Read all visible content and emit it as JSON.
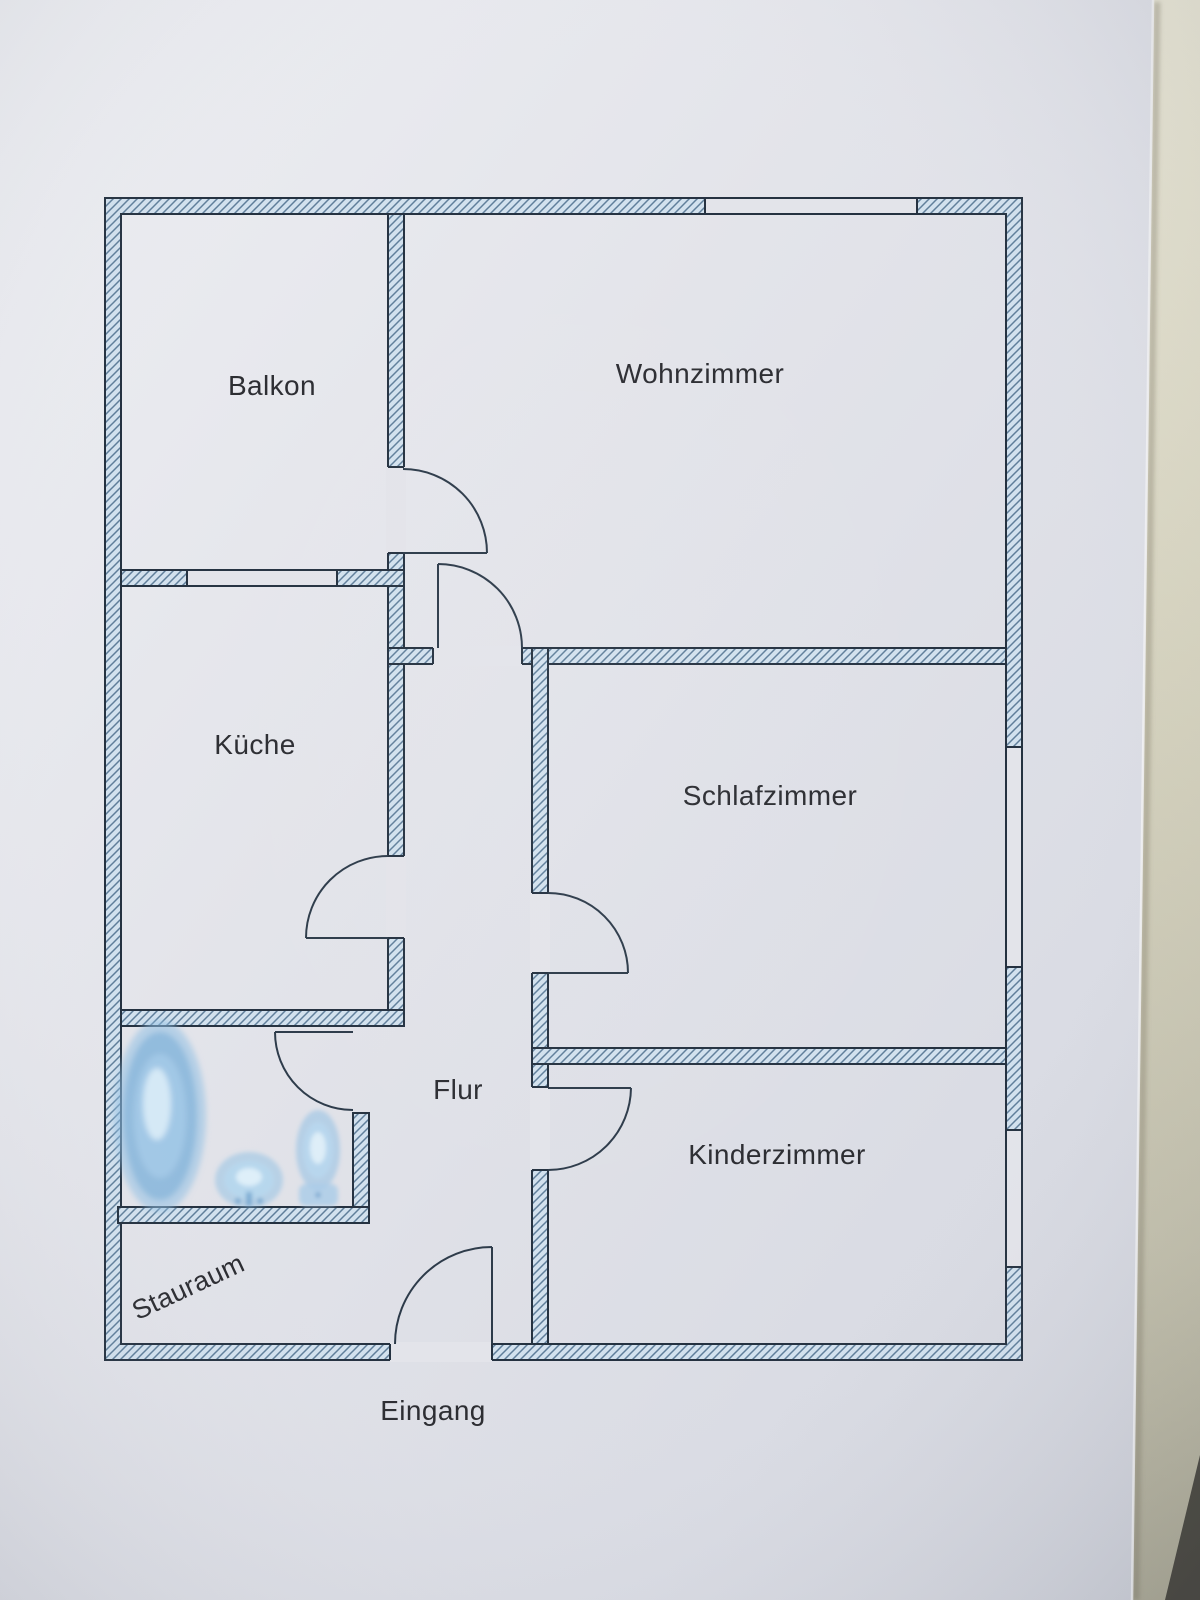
{
  "rooms": [
    {
      "label": "Balkon"
    },
    {
      "label": "Wohnzimmer"
    },
    {
      "label": "Küche"
    },
    {
      "label": "Schlafzimmer"
    },
    {
      "label": "Flur"
    },
    {
      "label": "Kinderzimmer"
    },
    {
      "label": "Stauraum"
    }
  ],
  "entrance": {
    "label": "Eingang"
  },
  "fixtures": [
    {
      "name": "bathtub-icon"
    },
    {
      "name": "sink-icon"
    },
    {
      "name": "toilet-icon"
    }
  ],
  "counts": {
    "rooms": 7,
    "doors": 7,
    "windows": 4
  },
  "colors": {
    "paper": "#e3e4ea",
    "table": "#d2cfba",
    "wall_fill": "#d2e1ee",
    "wall_hatch_line": "#5f7e9a",
    "wall_outline": "#243140",
    "label_text": "#2b2c31",
    "fixture_blue": "#8fc0e4"
  }
}
